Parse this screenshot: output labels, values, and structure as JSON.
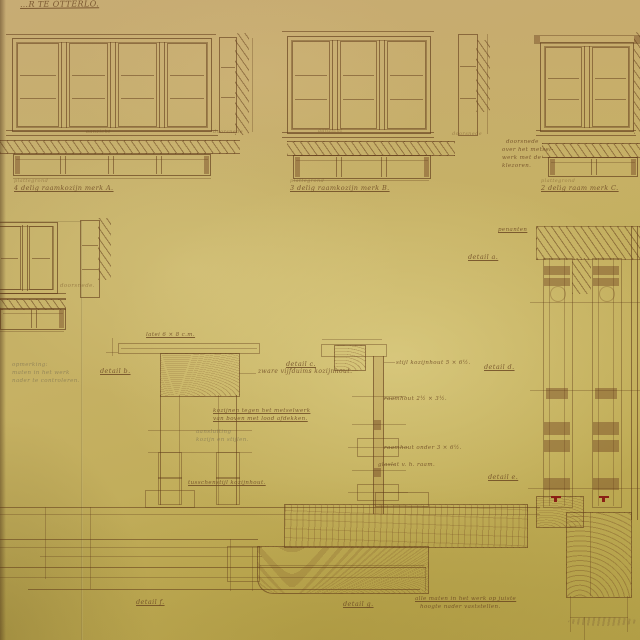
{
  "title": {
    "text": "…R TE OTTERLO."
  },
  "palette": {
    "paper": "#c2ae62",
    "ink": "#6f4a26",
    "pencil": "#7a6f55",
    "red_mark": "#8a2015"
  },
  "figures": [
    "window-merk-a-elevation-section-plan",
    "window-merk-b-elevation-section-plan",
    "window-merk-c-elevation-plan",
    "small-window-elevation-section-plan",
    "mullion-detail-column-right",
    "lintel-detail-b",
    "mullion-detail-c",
    "sill-details-bottom"
  ],
  "annotations": [
    {
      "name": "label-aanzicht-a",
      "x": 86,
      "y": 130,
      "size": 5,
      "cls": "faded",
      "text": "aanzicht"
    },
    {
      "name": "label-doorsnede-a",
      "x": 213,
      "y": 130,
      "size": 5,
      "cls": "faded",
      "text": "doorsnede"
    },
    {
      "name": "label-plattegrond-a",
      "x": 14,
      "y": 179,
      "size": 5,
      "cls": "faded",
      "text": "plattegrond"
    },
    {
      "name": "caption-merk-a",
      "x": 14,
      "y": 185,
      "size": 6.5,
      "cls": "ink",
      "underline": true,
      "text": "4 delig raamkozijn    merk A."
    },
    {
      "name": "label-aanzicht-b",
      "x": 318,
      "y": 129,
      "size": 5,
      "cls": "faded",
      "text": "aanzicht"
    },
    {
      "name": "label-doorsnede-b",
      "x": 452,
      "y": 132,
      "size": 5,
      "cls": "faded",
      "text": "doorsnede"
    },
    {
      "name": "label-plattegrond-b",
      "x": 290,
      "y": 179,
      "size": 5,
      "cls": "faded",
      "text": "plattegrond"
    },
    {
      "name": "caption-merk-b",
      "x": 290,
      "y": 185,
      "size": 6.5,
      "cls": "ink",
      "underline": true,
      "text": "3 delig raamkozijn    merk B."
    },
    {
      "name": "note-doorsnede-line1",
      "x": 506,
      "y": 139,
      "size": 5.5,
      "cls": "ink",
      "text": "doorsnede"
    },
    {
      "name": "note-doorsnede-line2",
      "x": 502,
      "y": 147,
      "size": 5.5,
      "cls": "ink",
      "text": "over het metsel-"
    },
    {
      "name": "note-doorsnede-line3",
      "x": 502,
      "y": 155,
      "size": 5.5,
      "cls": "ink",
      "text": "werk met de"
    },
    {
      "name": "note-doorsnede-line4",
      "x": 502,
      "y": 163,
      "size": 5.5,
      "cls": "ink",
      "text": "klezoren."
    },
    {
      "name": "label-plattegrond-c",
      "x": 541,
      "y": 179,
      "size": 5,
      "cls": "faded",
      "text": "plattegrond"
    },
    {
      "name": "caption-merk-c",
      "x": 541,
      "y": 185,
      "size": 6.5,
      "cls": "ink",
      "underline": true,
      "text": "2 delig raam    merk C."
    },
    {
      "name": "label-doorsnede-d",
      "x": 60,
      "y": 283,
      "size": 5.5,
      "cls": "faded",
      "text": "doorsnede."
    },
    {
      "name": "pencil-note-line1",
      "x": 12,
      "y": 362,
      "size": 5.5,
      "cls": "pencil",
      "text": "opmerking:"
    },
    {
      "name": "pencil-note-line2",
      "x": 12,
      "y": 370,
      "size": 5.5,
      "cls": "pencil",
      "text": "maten in het werk"
    },
    {
      "name": "pencil-note-line3",
      "x": 12,
      "y": 378,
      "size": 5.5,
      "cls": "pencil",
      "text": "nader te controleren."
    },
    {
      "name": "label-penanten",
      "x": 498,
      "y": 227,
      "size": 5.5,
      "cls": "ink",
      "underline": true,
      "text": "penanten"
    },
    {
      "name": "label-detail-a",
      "x": 468,
      "y": 254,
      "size": 6.5,
      "cls": "ink",
      "underline": true,
      "text": "detail a."
    },
    {
      "name": "label-latei",
      "x": 146,
      "y": 332,
      "size": 5.5,
      "cls": "ink",
      "underline": true,
      "text": "latei 6 × 8 c.m."
    },
    {
      "name": "label-detail-b",
      "x": 100,
      "y": 368,
      "size": 6.5,
      "cls": "ink",
      "underline": true,
      "text": "detail b."
    },
    {
      "name": "note-kozijnhout",
      "x": 258,
      "y": 369,
      "size": 6,
      "cls": "ink",
      "text": "zware vijfduims kozijnhout."
    },
    {
      "name": "label-detail-c",
      "x": 286,
      "y": 361,
      "size": 6.5,
      "cls": "ink",
      "underline": true,
      "text": "detail c."
    },
    {
      "name": "note-stijl-kozijnhout",
      "x": 396,
      "y": 360,
      "size": 5.5,
      "cls": "ink",
      "text": "stijl kozijnhout 5 × 6½."
    },
    {
      "name": "note-raamhout-boven",
      "x": 384,
      "y": 396,
      "size": 5.5,
      "cls": "ink",
      "text": "raamhout 2½ × 3½."
    },
    {
      "name": "note-metselwerk-line1",
      "x": 213,
      "y": 408,
      "size": 5.5,
      "cls": "ink",
      "underline": true,
      "text": "kozijnen tegen het metselwerk"
    },
    {
      "name": "note-metselwerk-line2",
      "x": 213,
      "y": 416,
      "size": 5.5,
      "cls": "ink",
      "underline": true,
      "text": "van boven met lood afdekken."
    },
    {
      "name": "note-aansluiting-line1",
      "x": 196,
      "y": 429,
      "size": 5.5,
      "cls": "pencil",
      "text": "aansluiting"
    },
    {
      "name": "note-aansluiting-line2",
      "x": 196,
      "y": 437,
      "size": 5.5,
      "cls": "pencil",
      "text": "kozijn en stijlen."
    },
    {
      "name": "label-detail-d",
      "x": 484,
      "y": 364,
      "size": 6.5,
      "cls": "ink",
      "underline": true,
      "text": "detail d."
    },
    {
      "name": "note-raamhout-onder",
      "x": 384,
      "y": 445,
      "size": 5.5,
      "cls": "ink",
      "text": "raamhout onder 3 × 6½."
    },
    {
      "name": "note-glaslat",
      "x": 378,
      "y": 462,
      "size": 5.5,
      "cls": "ink",
      "text": "glaslat v. h. raam."
    },
    {
      "name": "label-tusschenstijl",
      "x": 188,
      "y": 480,
      "size": 5.5,
      "cls": "ink",
      "underline": true,
      "text": "tusschenstijl kozijnhout."
    },
    {
      "name": "label-detail-e",
      "x": 488,
      "y": 474,
      "size": 6.5,
      "cls": "ink",
      "underline": true,
      "text": "detail e."
    },
    {
      "name": "label-detail-f",
      "x": 136,
      "y": 599,
      "size": 6.5,
      "cls": "ink",
      "underline": true,
      "text": "detail f."
    },
    {
      "name": "label-detail-g",
      "x": 343,
      "y": 601,
      "size": 6.5,
      "cls": "ink",
      "underline": true,
      "text": "detail g."
    },
    {
      "name": "note-maten-line1",
      "x": 415,
      "y": 596,
      "size": 5.5,
      "cls": "ink",
      "underline": true,
      "text": "alle maten in het werk op juiste"
    },
    {
      "name": "note-maten-line2",
      "x": 420,
      "y": 604,
      "size": 5.5,
      "cls": "ink",
      "text": "hoogte nader vaststellen."
    }
  ]
}
